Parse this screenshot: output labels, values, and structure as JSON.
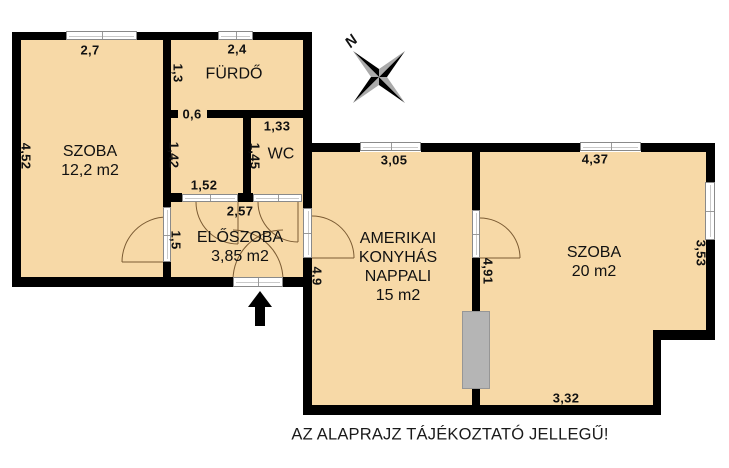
{
  "disclaimer": "AZ ALAPRAJZ TÁJÉKOZTATÓ JELLEGŰ!",
  "compass": {
    "north_label": "N"
  },
  "rooms": {
    "szoba_left": {
      "name": "SZOBA",
      "area": "12,2 m2"
    },
    "furdo": {
      "name": "FÜRDŐ"
    },
    "wc": {
      "name": "WC"
    },
    "eloszoba": {
      "name": "ELŐSZOBA",
      "area": "3,85 m2"
    },
    "nappali": {
      "line1": "AMERIKAI",
      "line2": "KONYHÁS",
      "line3": "NAPPALI",
      "area": "15 m2"
    },
    "szoba_right": {
      "name": "SZOBA",
      "area": "20 m2"
    }
  },
  "dims": {
    "top_szoba": "2,7",
    "top_furdo": "2,4",
    "furdo_h": "1,3",
    "furdo_door": "0,6",
    "wc_w": "1,33",
    "lobby_h": "1,42",
    "wc_h": "1,45",
    "lobby_w": "1,52",
    "eloszoba_w": "2,57",
    "eloszoba_h": "1,5",
    "szoba_left_h": "4,52",
    "nappali_top": "3,05",
    "szoba_right_top": "4,37",
    "nappali_h": "4,9",
    "partition_h": "4,91",
    "szoba_right_side": "3,53",
    "szoba_right_bottom": "3,32"
  },
  "colors": {
    "floor": "#f7d9a7",
    "wall": "#000000",
    "shaft": "#b5b5b5",
    "door_arc": "#7b5b33"
  }
}
